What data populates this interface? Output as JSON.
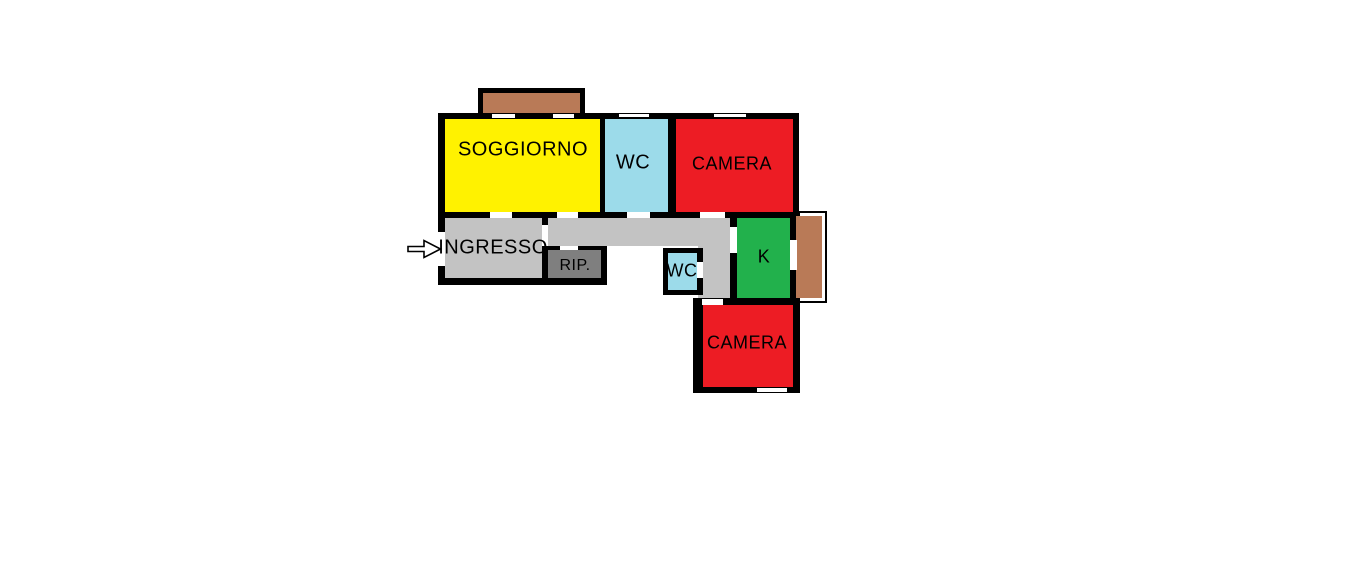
{
  "page": {
    "background": "#ffffff"
  },
  "floorplan": {
    "type": "apartment-floor-plan-sketch",
    "colors": {
      "wall": "#000000",
      "opening": "#ffffff",
      "soggiorno": "#fff200",
      "wc": "#9cdbea",
      "camera": "#ed1c24",
      "corridor": "#c3c3c3",
      "rip": "#7f7f7f",
      "kitchen": "#22b14c",
      "balcony": "#b97a57",
      "arrow_fill": "#ffffff",
      "arrow_outline": "#000000"
    },
    "rooms": [
      {
        "name": "soggiorno",
        "label": "SOGGIORNO"
      },
      {
        "name": "wc_top",
        "label": "WC"
      },
      {
        "name": "camera_top",
        "label": "CAMERA"
      },
      {
        "name": "ingresso",
        "label": "INGRESSO"
      },
      {
        "name": "rip",
        "label": "RIP."
      },
      {
        "name": "wc_small",
        "label": "WC"
      },
      {
        "name": "kitchen",
        "label": "K"
      },
      {
        "name": "camera_bottom",
        "label": "CAMERA"
      }
    ]
  }
}
